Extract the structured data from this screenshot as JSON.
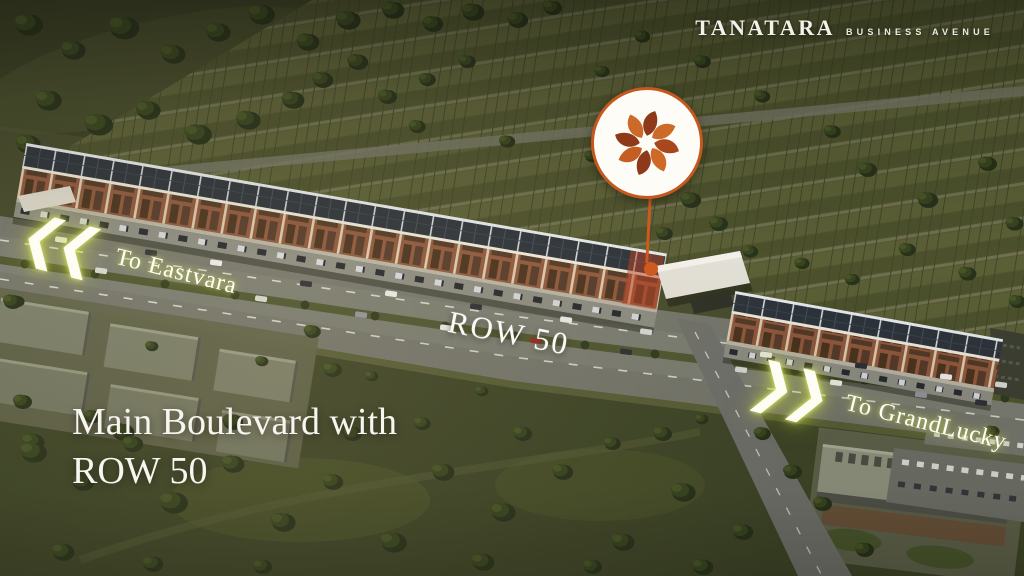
{
  "brand": {
    "name": "TANATARA",
    "tagline": "BUSINESS AVENUE"
  },
  "badge": {
    "icon": "tanatara-flower-logo",
    "ring_color": "#c4581e",
    "petal_colors": [
      "#8e3a1a",
      "#cd6a28",
      "#a8471d",
      "#cd6a28",
      "#8e3a1a",
      "#c55e22",
      "#8e3a1a",
      "#cd6a28"
    ]
  },
  "annotations": {
    "direction_left": {
      "chevrons": "❮❮",
      "label": "To Eastvara"
    },
    "road_label": "ROW 50",
    "direction_right": {
      "chevrons": "❯❯",
      "label": "To GrandLucky"
    }
  },
  "caption": {
    "line1": "Main Boulevard with",
    "line2": "ROW 50"
  },
  "colors": {
    "accent_orange": "#cf5a1f",
    "glow_yellow": "#d9e556",
    "text_white": "#f7f5ee"
  }
}
